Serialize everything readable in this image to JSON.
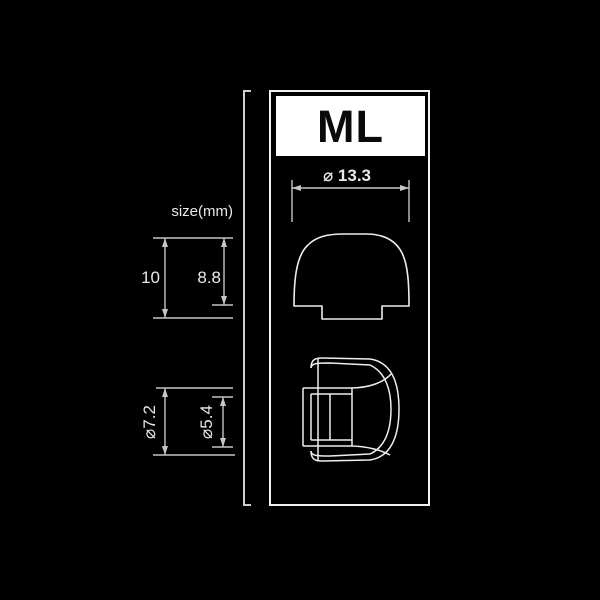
{
  "badge": {
    "label": "ML"
  },
  "unit_label": "size(mm)",
  "dimensions": {
    "umbrella_diameter": "⌀ 13.3",
    "total_height": "10",
    "umbrella_height": "8.8",
    "core_outer_diameter": "⌀7.2",
    "core_inner_diameter": "⌀5.4"
  },
  "figures": {
    "top": "ear-tip-side-profile",
    "bottom": "ear-tip-rotated-profile"
  },
  "colors": {
    "background": "#000000",
    "figure_line": "#eeeeee",
    "dimension_line": "#c6c6c6",
    "badge_background": "#ffffff",
    "badge_text": "#000000"
  }
}
